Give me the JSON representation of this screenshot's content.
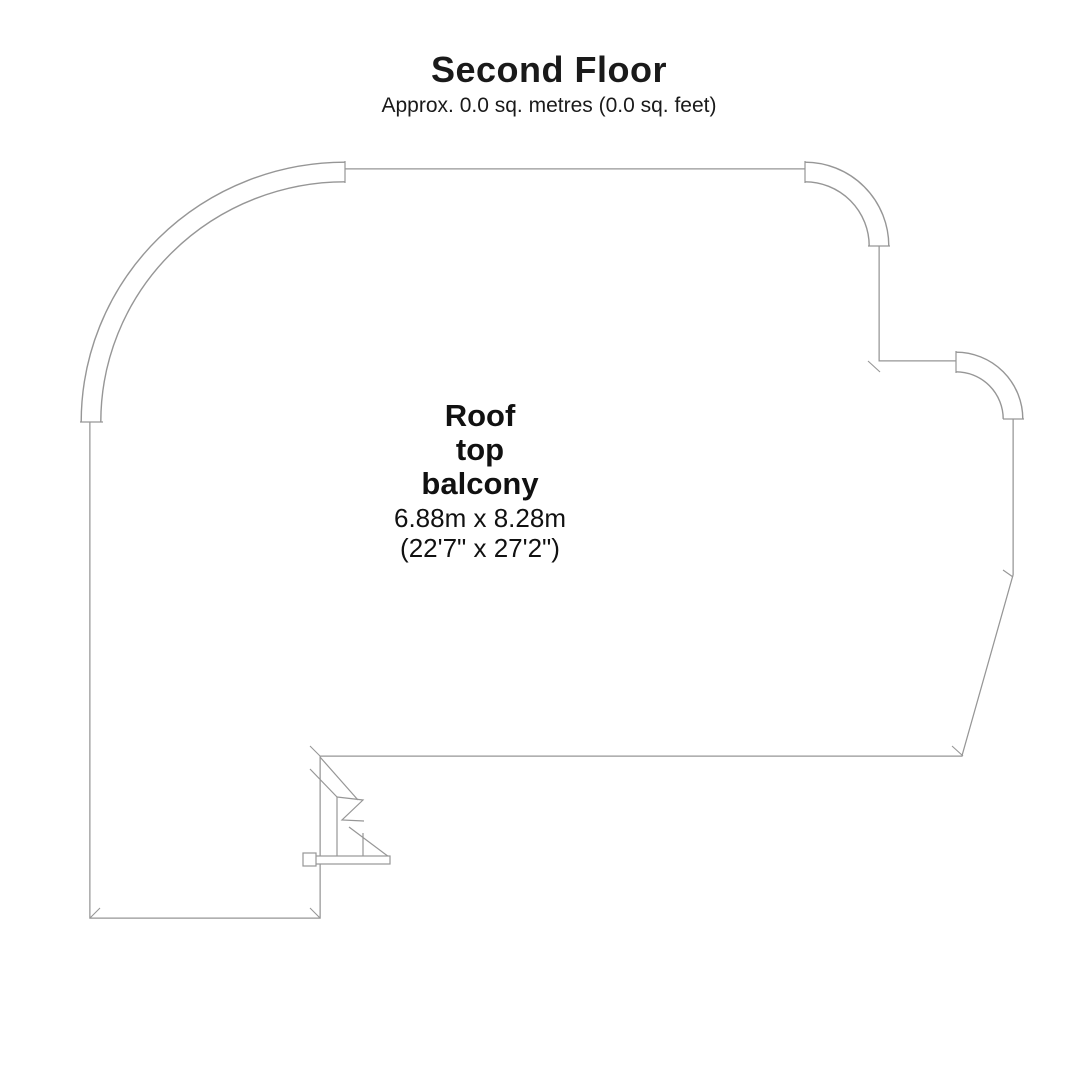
{
  "header": {
    "title": "Second Floor",
    "subtitle": "Approx. 0.0 sq. metres (0.0 sq. feet)"
  },
  "room": {
    "name_lines": [
      "Roof",
      "top",
      "balcony"
    ],
    "dimensions_metric": "6.88m x 8.28m",
    "dimensions_imperial": "(22'7\" x 27'2\")"
  },
  "colors": {
    "wall_line": "#969696",
    "interior_fill": "#ffffff",
    "text": "#1a1a1a",
    "background": "#ffffff"
  }
}
